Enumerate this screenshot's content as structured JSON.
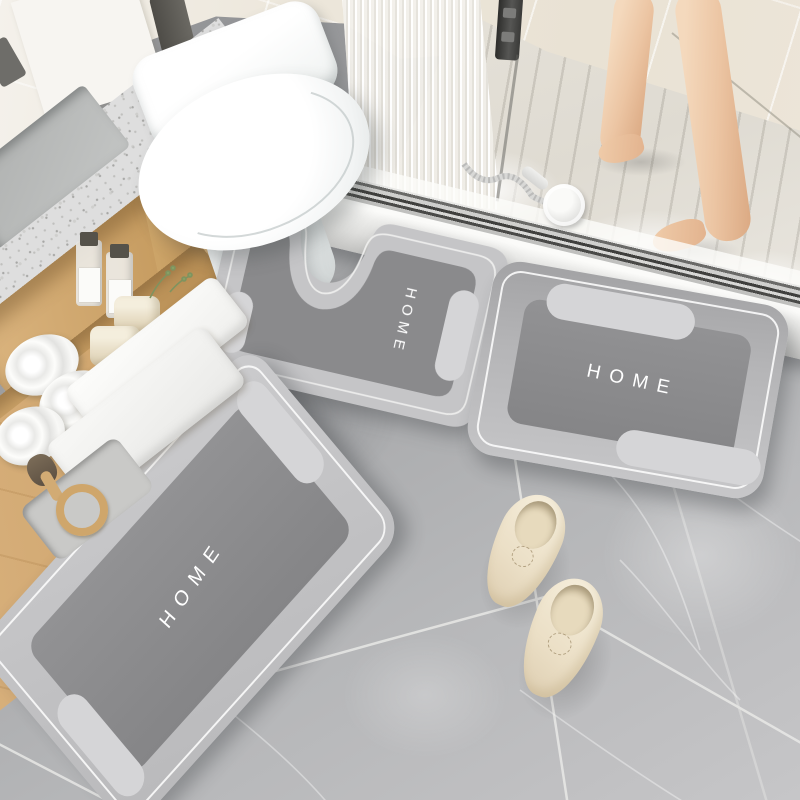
{
  "scene": {
    "description": "Bathroom product photo of a three-piece absorbent bath mat set",
    "objects": [
      "toilet",
      "wooden-vanity",
      "terrazzo-counter",
      "shower-enclosure",
      "person-legs",
      "hand-shower",
      "slippers",
      "towels",
      "toiletries"
    ]
  },
  "mats": {
    "contour": {
      "label": "HOME"
    },
    "runner": {
      "label": "HOME"
    },
    "rect": {
      "label": "HOME"
    }
  },
  "palette": {
    "mat_border": "#c4c4c6",
    "mat_center": "#88888a",
    "mat_pill": "#d5d5d7",
    "mat_text": "#ffffff",
    "floor_tile": "#aeafb1",
    "wall_tile": "#ebe5da",
    "wood": "#d9b583",
    "counter": "#dedede",
    "towel": "#f8f8f6",
    "skin": "#ecc5a3",
    "slipper": "#ece1c9",
    "drain_metal": "#c9c9c7"
  }
}
